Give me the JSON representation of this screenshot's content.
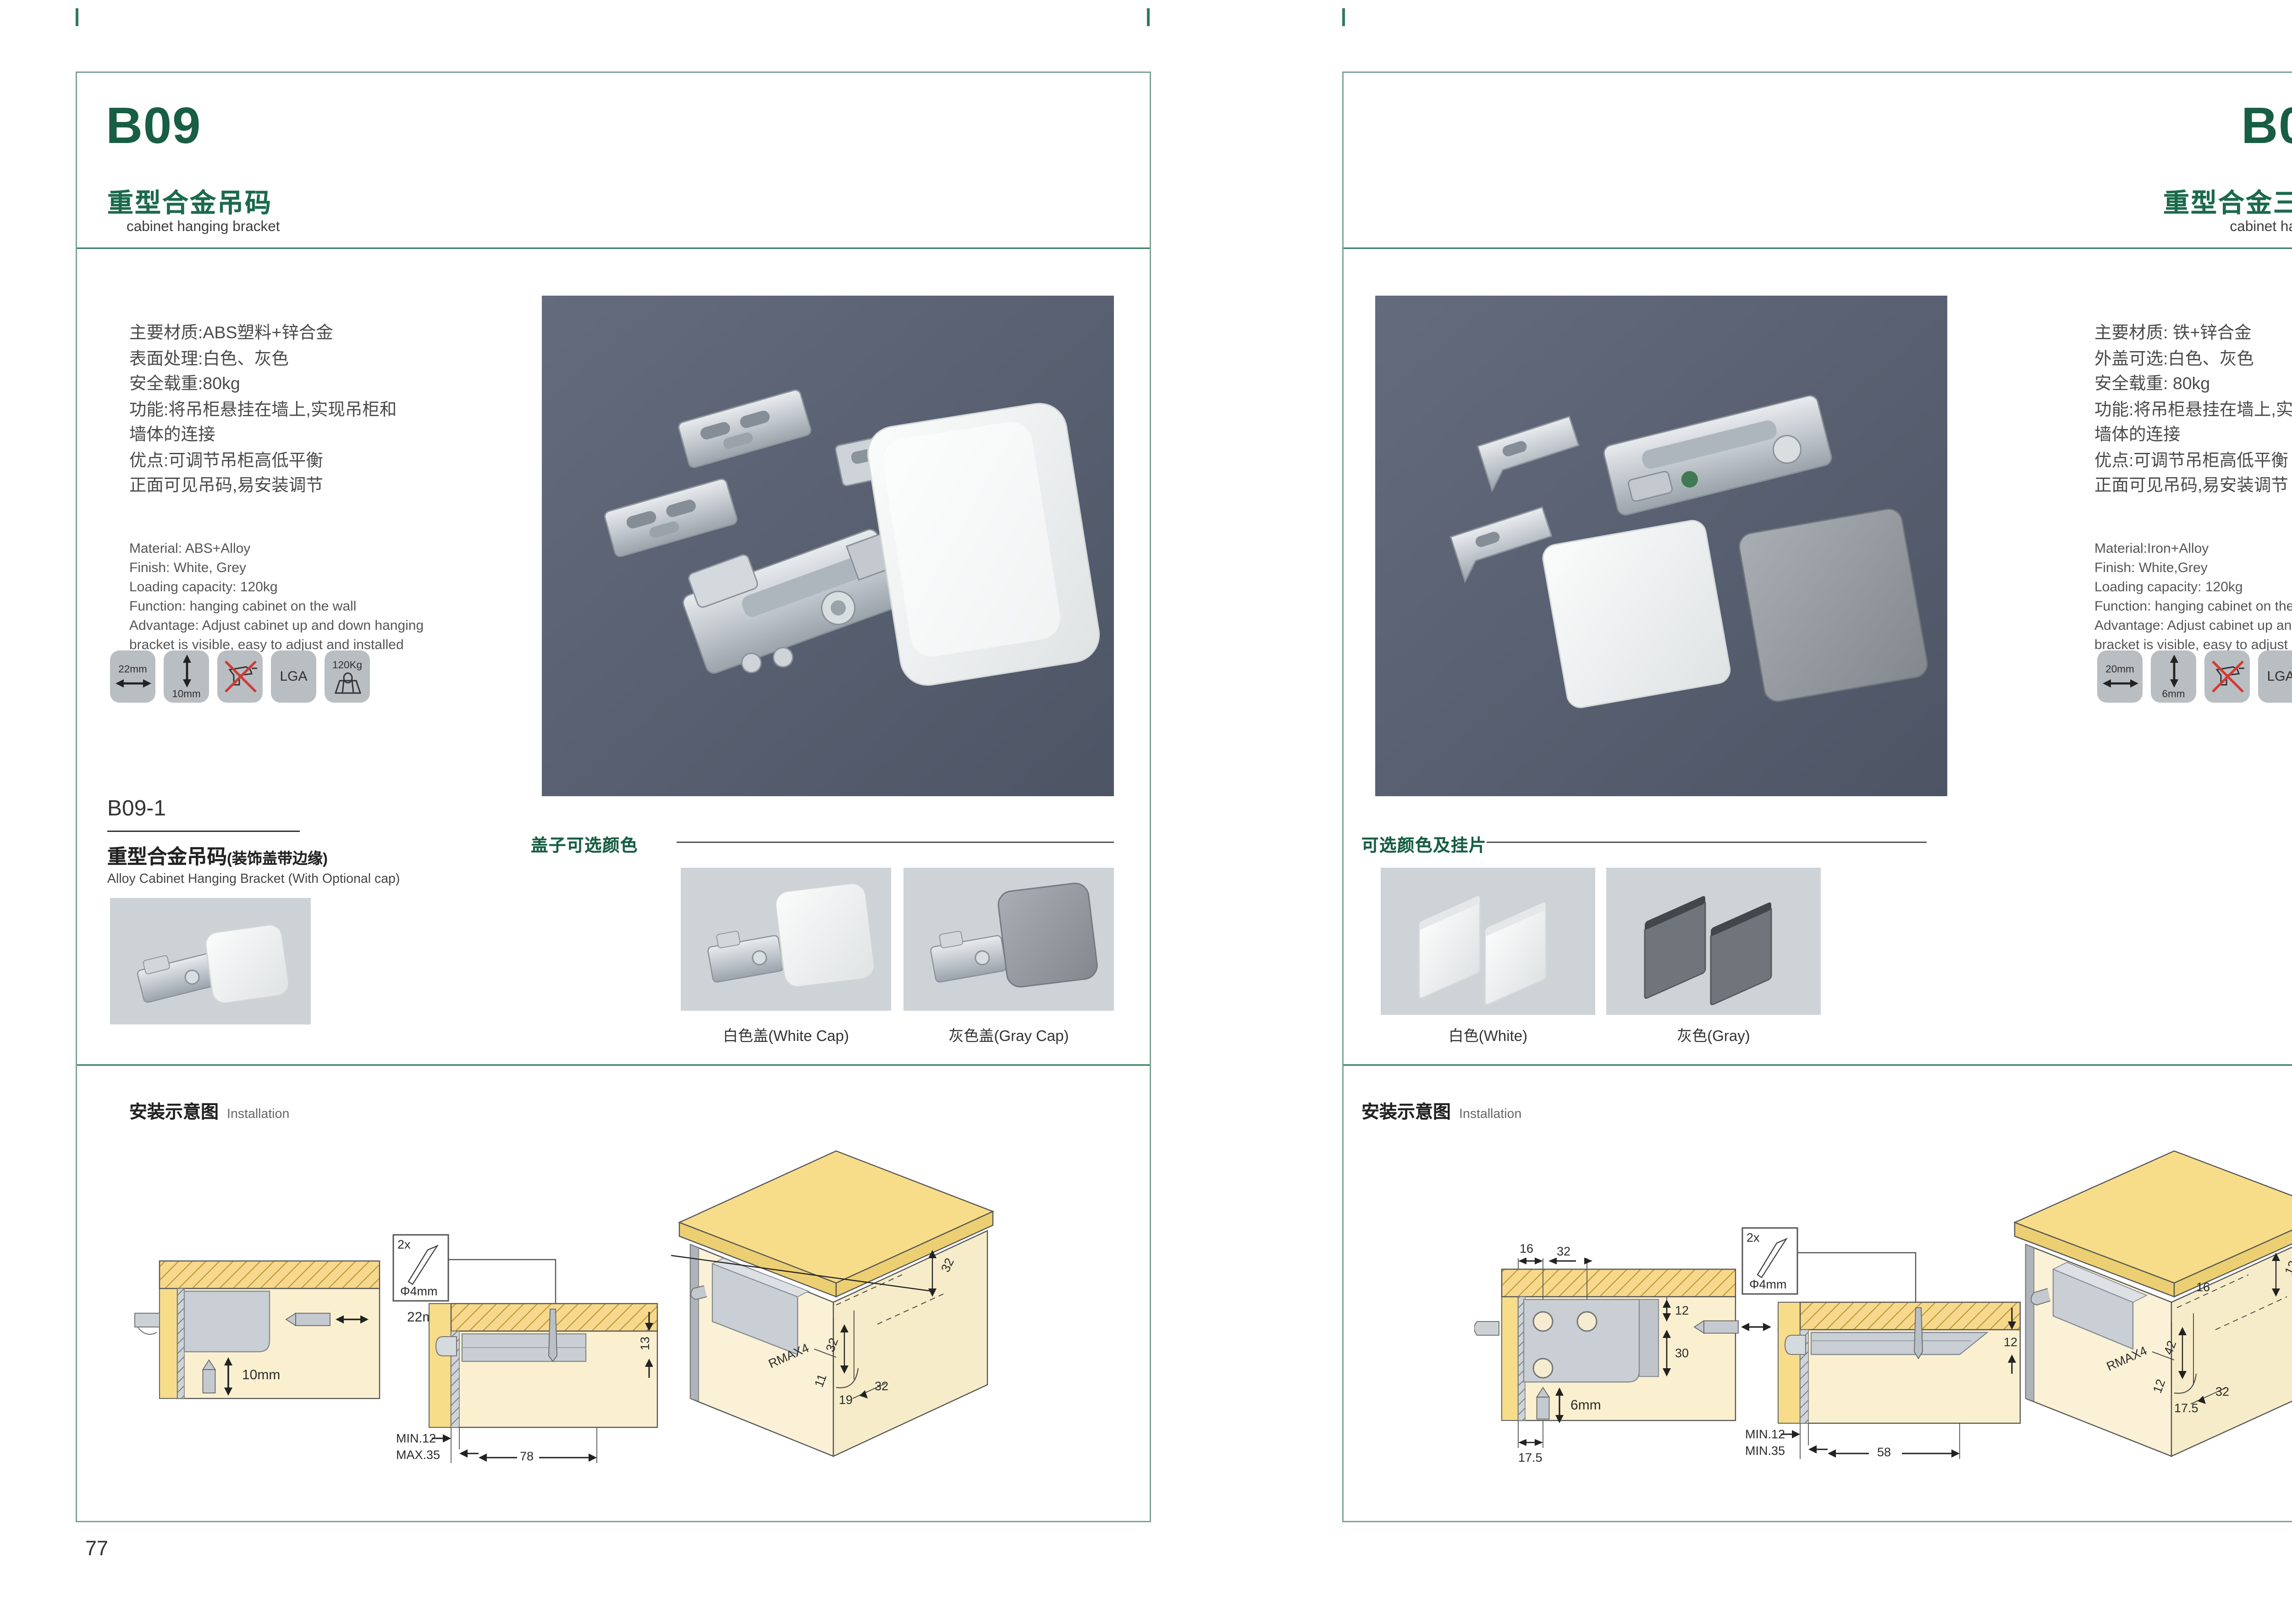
{
  "brand": {
    "green": "#185e44",
    "rule_green": "#2f7a5c",
    "photo_bg": "#59627355"
  },
  "left_page": {
    "code": "B09",
    "title_zh": "重型合金吊码",
    "subtitle_en": "cabinet hanging bracket",
    "specs_zh": [
      "主要材质:ABS塑料+锌合金",
      "表面处理:白色、灰色",
      "安全载重:80kg",
      "功能:将吊柜悬挂在墙上,实现吊柜和",
      "墙体的连接",
      "优点:可调节吊柜高低平衡",
      "正面可见吊码,易安装调节"
    ],
    "specs_en": [
      "Material: ABS+Alloy",
      "Finish: White, Grey",
      "Loading capacity: 120kg",
      "Function: hanging cabinet on the wall",
      "Advantage: Adjust cabinet up and down hanging",
      "bracket is visible, easy to adjust and installed"
    ],
    "icons": {
      "width": "22mm",
      "height": "10mm",
      "cert": "LGA",
      "load": "120Kg"
    },
    "sub_product": {
      "code": "B09-1",
      "title_zh": "重型合金吊码",
      "title_note": "(装饰盖带边缘)",
      "title_en": "Alloy Cabinet Hanging Bracket (With Optional cap)"
    },
    "caps": {
      "heading": "盖子可选颜色",
      "white_label": "白色盖(White Cap)",
      "gray_label": "灰色盖(Gray Cap)"
    },
    "installation": {
      "heading_zh": "安装示意图",
      "heading_en": "Installation",
      "diag1": {
        "width_label": "22mm",
        "height_label": "10mm"
      },
      "diag2": {
        "screw_qty": "2x",
        "screw_dia": "Φ4mm",
        "side": "13",
        "min": "MIN.12",
        "max": "MAX.35",
        "span": "78"
      },
      "diag3": {
        "top": "32",
        "mid": "32",
        "radius": "RMAX4",
        "d1": "11",
        "d2": "19",
        "d3": "32"
      }
    },
    "page_number": "77"
  },
  "right_page": {
    "code": "B09-3",
    "title_zh": "重型合金三孔吊码",
    "subtitle_en": "cabinet hanging bracket",
    "specs_zh": [
      "主要材质: 铁+锌合金",
      "外盖可选:白色、灰色",
      "安全载重: 80kg",
      "功能:将吊柜悬挂在墙上,实现吊柜和",
      "墙体的连接",
      "优点:可调节吊柜高低平衡",
      "正面可见吊码,易安装调节"
    ],
    "specs_en": [
      "Material:Iron+Alloy",
      "Finish: White,Grey",
      "Loading capacity: 120kg",
      "Function: hanging cabinet on the wall",
      "Advantage: Adjust cabinet up and down hanging",
      "bracket is visible, easy to adjust and installed"
    ],
    "icons": {
      "width": "20mm",
      "height": "6mm",
      "cert": "LGA",
      "load": "120Kg"
    },
    "caps": {
      "heading": "可选颜色及挂片",
      "white_label": "白色(White)",
      "gray_label": "灰色(Gray)"
    },
    "installation": {
      "heading_zh": "安装示意图",
      "heading_en": "Installation",
      "diag1": {
        "d16": "16",
        "d32": "32",
        "d12": "12",
        "d30": "30",
        "width_label": "20mm",
        "height_label": "6mm",
        "d175": "17.5"
      },
      "diag2": {
        "screw_qty": "2x",
        "screw_dia": "Φ4mm",
        "side": "12",
        "min": "MIN.12",
        "min2": "MIN.35",
        "span": "58"
      },
      "diag3": {
        "top": "12",
        "d16": "16",
        "d42": "42",
        "radius": "RMAX4",
        "d12": "12",
        "d175": "17.5",
        "d32": "32"
      }
    },
    "page_number": "78"
  }
}
